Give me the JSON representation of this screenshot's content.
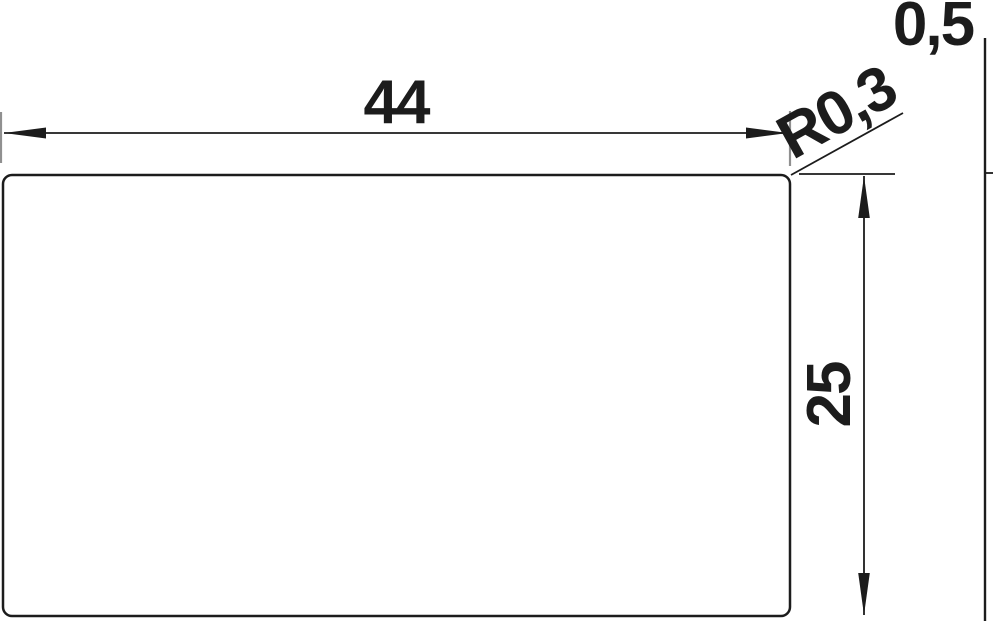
{
  "drawing": {
    "type": "technical-dimension-drawing",
    "labels": {
      "width": "44",
      "height": "25",
      "corner_radius": "R0,3",
      "thickness": "0,5"
    },
    "colors": {
      "line": "#1c1c1c",
      "extension": "#909090",
      "background": "#ffffff"
    }
  }
}
